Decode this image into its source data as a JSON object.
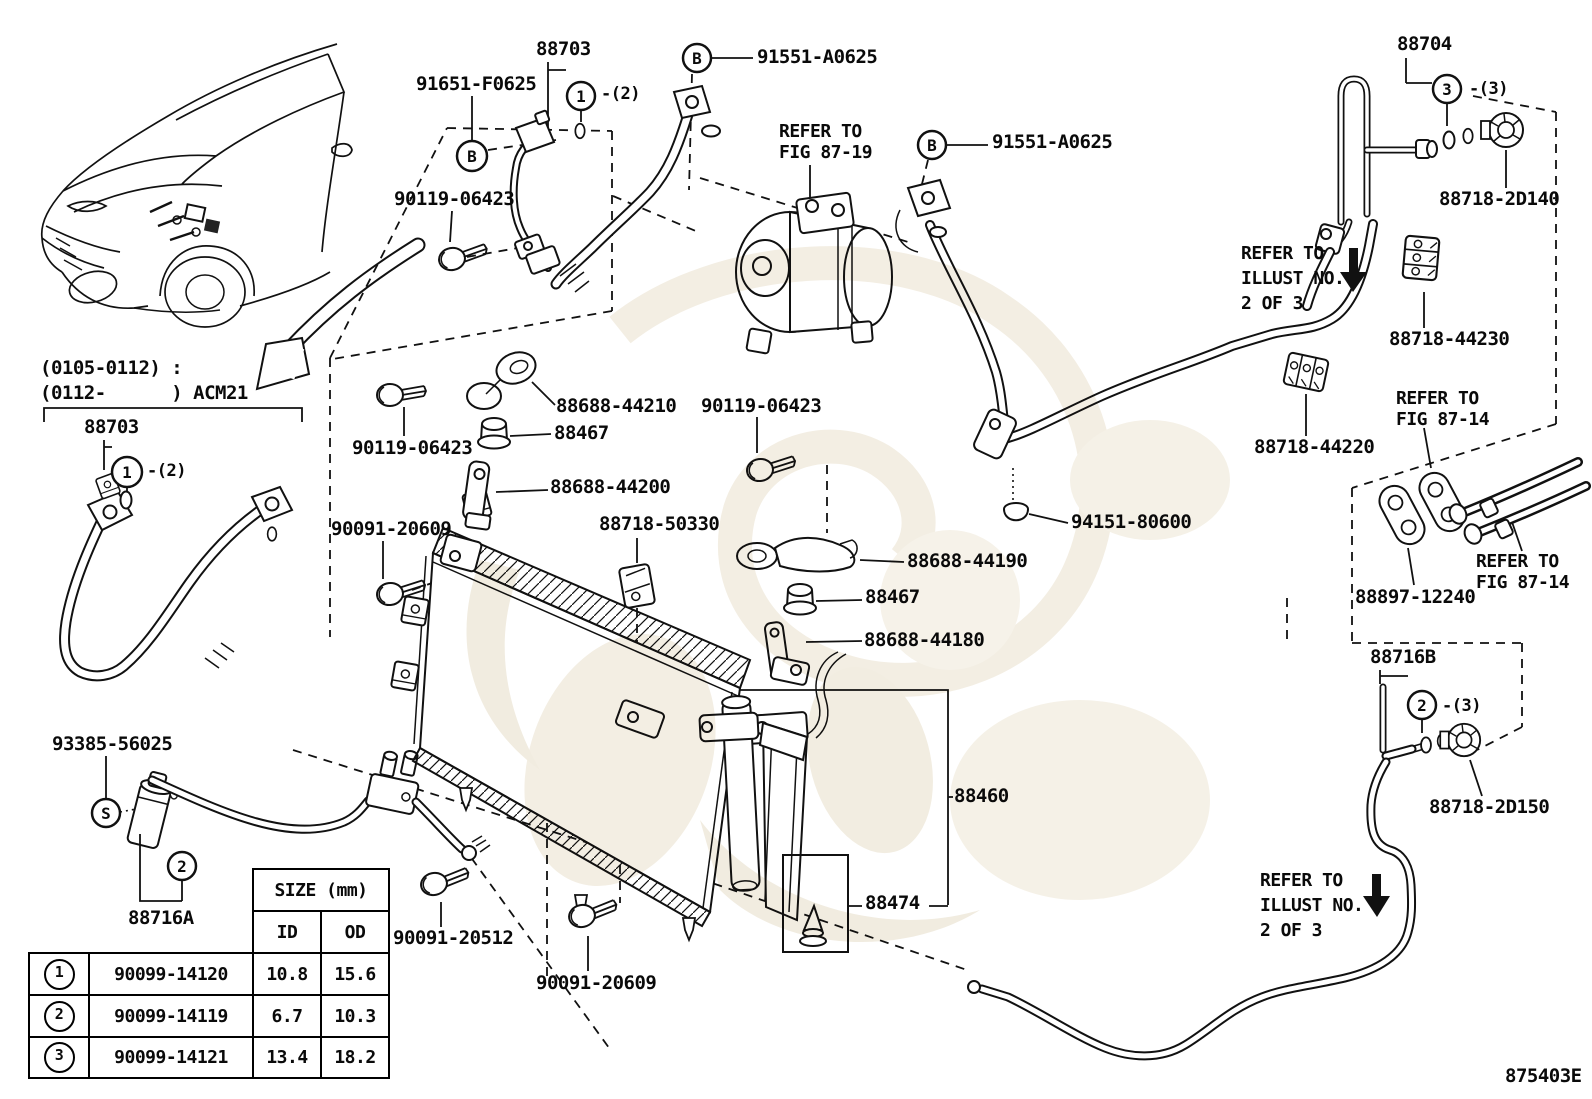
{
  "labels": {
    "p88703": "88703",
    "p91651": "91651-F0625",
    "p91551": "91551-A0625",
    "p90119": "90119-06423",
    "p88704": "88704",
    "p2d140": "88718-2D140",
    "p44230": "88718-44230",
    "p44220": "88718-44220",
    "p44210": "88688-44210",
    "p44200": "88688-44200",
    "p44190": "88688-44190",
    "p44180": "88688-44180",
    "p88467": "88467",
    "p50330": "88718-50330",
    "p20609": "90091-20609",
    "p20512": "90091-20512",
    "p94151": "94151-80600",
    "p12240": "88897-12240",
    "p2d150": "88718-2D150",
    "p88716a": "88716A",
    "p88716b": "88716B",
    "p88460": "88460",
    "p88474": "88474",
    "p93385": "93385-56025"
  },
  "refer": {
    "refer_to": "REFER TO",
    "fig_87_19": "FIG 87-19",
    "fig_87_14": "FIG 87-14",
    "illust_no": "ILLUST NO.",
    "two_of_three": "2 OF 3"
  },
  "callouts": {
    "one": "1",
    "two": "2",
    "three": "3",
    "b": "B",
    "s": "S",
    "qty2": "-(2)",
    "qty3": "-(3)"
  },
  "notes": {
    "line1": "(0105-0112) :",
    "line2": "(0112-      ) ACM21"
  },
  "table": {
    "size_header": "SIZE (mm)",
    "id_header": "ID",
    "od_header": "OD",
    "rows": [
      {
        "num": "1",
        "part": "90099-14120",
        "id": "10.8",
        "od": "15.6"
      },
      {
        "num": "2",
        "part": "90099-14119",
        "id": "6.7",
        "od": "10.3"
      },
      {
        "num": "3",
        "part": "90099-14121",
        "id": "13.4",
        "od": "18.2"
      }
    ]
  },
  "footer": {
    "code": "875403E"
  }
}
